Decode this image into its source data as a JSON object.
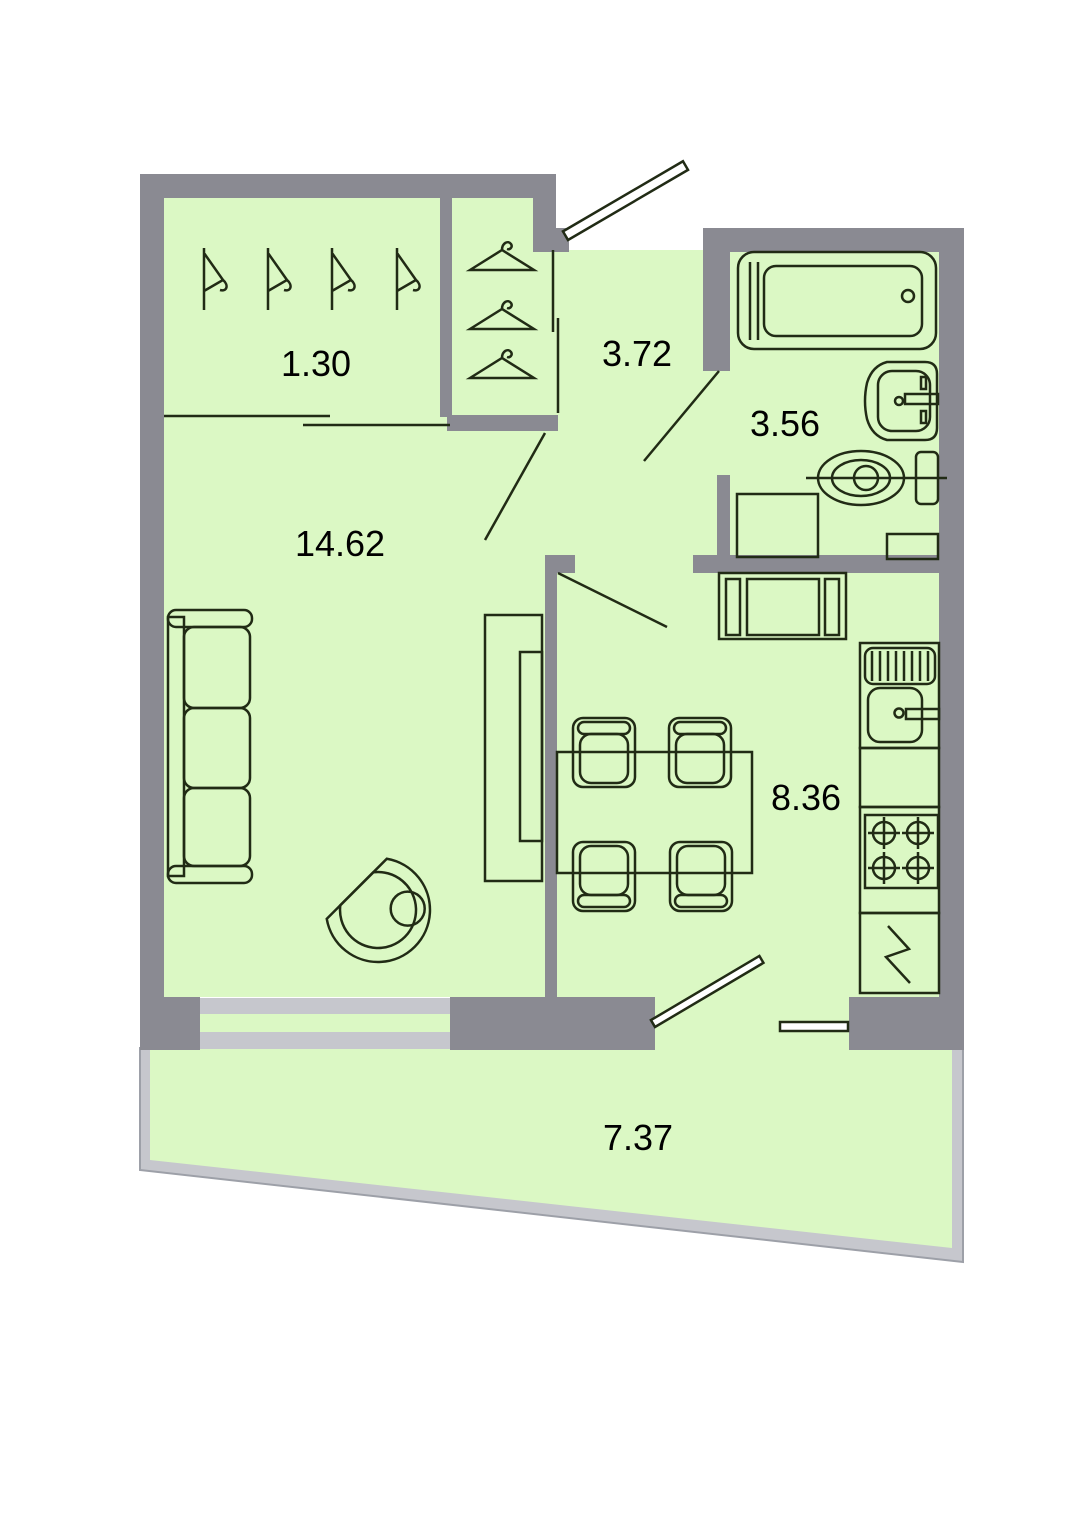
{
  "title": "Apartment floor plan",
  "rooms": {
    "wardrobe": {
      "label": "1.30"
    },
    "hallway": {
      "label": "3.72"
    },
    "bathroom": {
      "label": "3.56"
    },
    "living_room": {
      "label": "14.62"
    },
    "kitchen": {
      "label": "8.36"
    },
    "balcony": {
      "label": "7.37"
    }
  },
  "fixtures": [
    "coat-hanger-side-icon",
    "coat-hanger-front-icon",
    "entrance-door",
    "bathtub",
    "washbasin",
    "toilet",
    "washing-machine",
    "bathroom-shelf",
    "sofa",
    "armchair",
    "tv-cabinet",
    "dining-table",
    "dining-chair",
    "kitchen-counter-appliance",
    "kitchen-sink",
    "stove",
    "refrigerator",
    "window",
    "balcony-door",
    "door-swing"
  ],
  "colors": {
    "floor": "#dbf8c4",
    "wall": "#8a8a92",
    "balcony_wall": "#c6c7cd",
    "outline": "#212b15",
    "label": "#000000",
    "background": "#ffffff"
  }
}
